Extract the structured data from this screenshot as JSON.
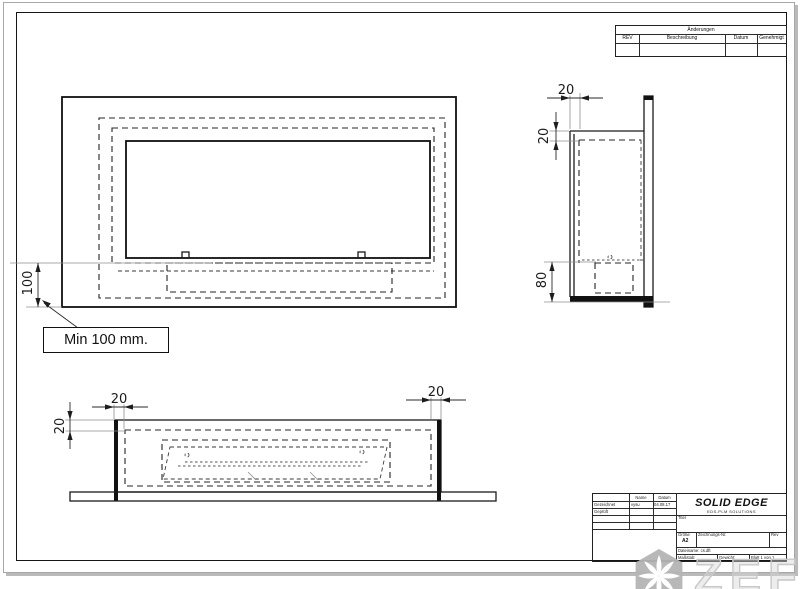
{
  "revision_table": {
    "title": "Änderungen",
    "col_rev": "REV",
    "col_desc": "Beschreibung",
    "col_date": "Datum",
    "col_approved": "Genehmigt"
  },
  "title_block": {
    "col_name": "Name",
    "col_date": "Datum",
    "row_drawn_label": "Gezeichnet",
    "row_drawn_name": "vysu",
    "row_drawn_date": "04.08.17",
    "row_checked_label": "Geprüft",
    "logo_title": "SOLID EDGE",
    "logo_subtitle": "EDS-PLM SOLUTIONS",
    "title_label": "Titel",
    "size_label": "Größe",
    "size_value": "A2",
    "dwgno_label": "Zeichnungs-Nr.",
    "rev_label": "Rev",
    "filename_label": "Dateiname:",
    "filename_value": "cs.dft",
    "scale_label": "Maßstab:",
    "weight_label": "Gewicht:",
    "sheet_label": "Blatt 1 von 1"
  },
  "dimensions": {
    "front_wall_gap": "100",
    "front_note": "Min 100 mm.",
    "side_top_wall": "20",
    "side_left_wall": "20",
    "side_burner": "80",
    "bottom_wall_left": "20",
    "bottom_wall_right": "20",
    "bottom_front_wall": "20"
  },
  "watermark": {
    "text": "ZEFIRE"
  },
  "colors": {
    "line": "#1b1b1b",
    "ext_line": "#8f8f8f",
    "watermark": "#c8c8c8"
  }
}
